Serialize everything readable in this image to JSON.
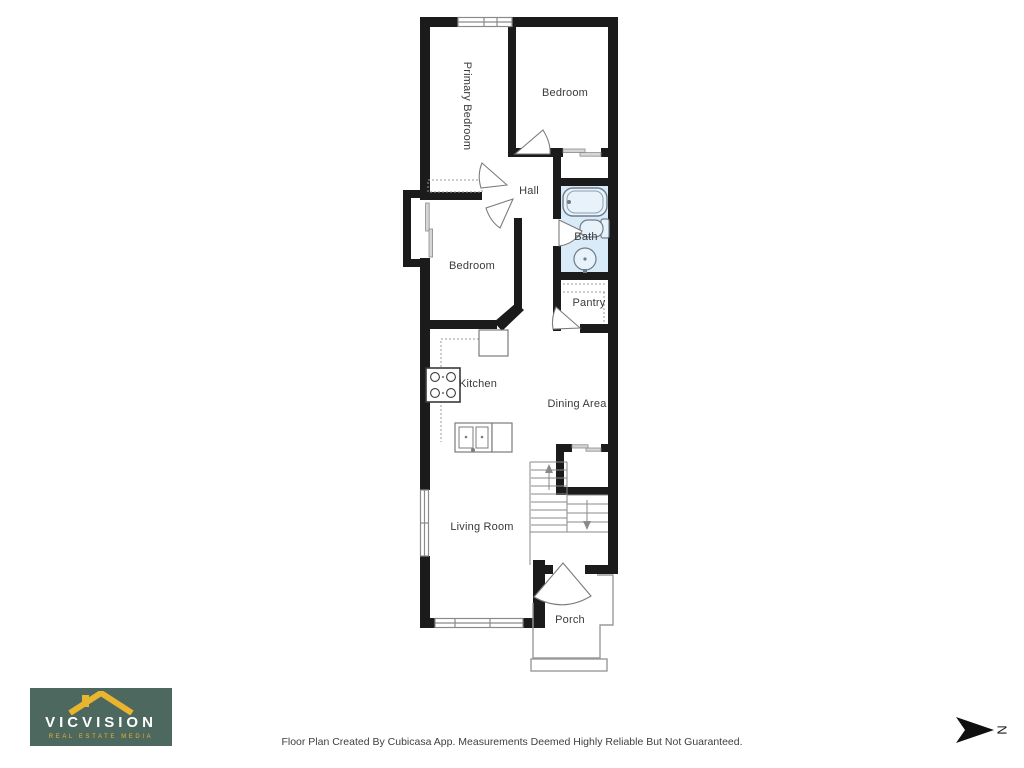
{
  "floor_plan": {
    "rooms": [
      {
        "label": "Primary Bedroom"
      },
      {
        "label": "Bedroom"
      },
      {
        "label": "Hall"
      },
      {
        "label": "Bath"
      },
      {
        "label": "Bedroom"
      },
      {
        "label": "Pantry"
      },
      {
        "label": "Kitchen"
      },
      {
        "label": "Dining Area"
      },
      {
        "label": "Living Room"
      },
      {
        "label": "Porch"
      }
    ],
    "fixtures": [
      "bathtub",
      "toilet",
      "sink",
      "stove",
      "kitchen-sink",
      "refrigerator",
      "pantry-shelves",
      "wardrobe",
      "stairs-up",
      "stairs-down",
      "sliding-closet-doors",
      "windows",
      "front-door",
      "porch-steps"
    ],
    "colors": {
      "wall": "#1b1b1b",
      "bath_fill": "#d9eaf8",
      "fixture_line": "#7c7c7c",
      "thin_line": "#9a9a9a"
    }
  },
  "branding": {
    "name": "VICVISION",
    "tagline": "REAL ESTATE MEDIA",
    "background": "#4d685e",
    "accent": "#e9b42e"
  },
  "footer": {
    "disclaimer": "Floor Plan Created By Cubicasa App. Measurements Deemed Highly Reliable But Not Guaranteed."
  },
  "compass": {
    "label": "N"
  }
}
